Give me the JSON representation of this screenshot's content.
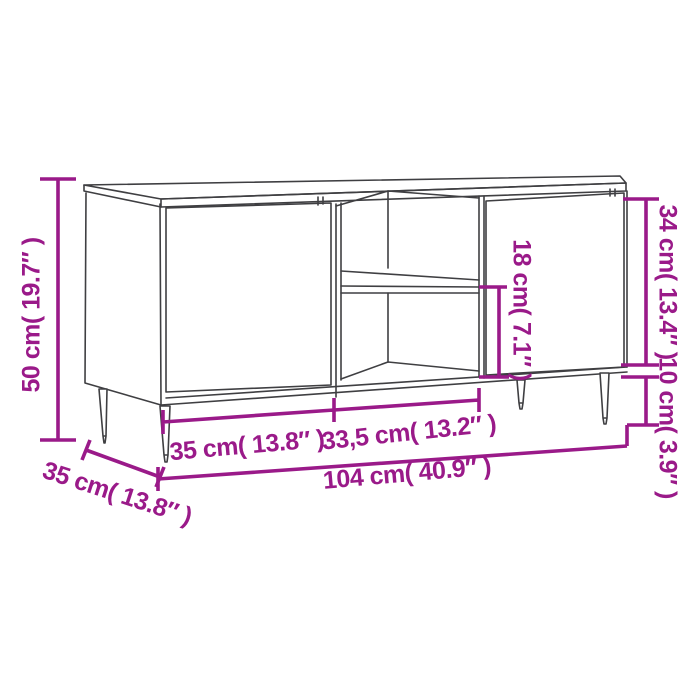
{
  "diagram": {
    "kind": "furniture-dimension-line-drawing",
    "colors": {
      "dimension": "#9A1A89",
      "outline": "#3F3F42",
      "background": "#FFFFFF"
    },
    "dimensions": {
      "height": {
        "label": "50 cm( 19.7″ )"
      },
      "depth": {
        "label": "35 cm( 13.8″ )"
      },
      "left_width": {
        "label": "35 cm( 13.8″ )"
      },
      "right_width": {
        "label": "33,5 cm( 13.2″ )"
      },
      "total_width": {
        "label": "104 cm( 40.9″ )"
      },
      "carcass_height": {
        "label": "34 cm( 13.4″ )"
      },
      "leg_height": {
        "label": "10 cm( 3.9″ )"
      },
      "shelf_height": {
        "label": "18 cm( 7.1″ )"
      }
    }
  }
}
